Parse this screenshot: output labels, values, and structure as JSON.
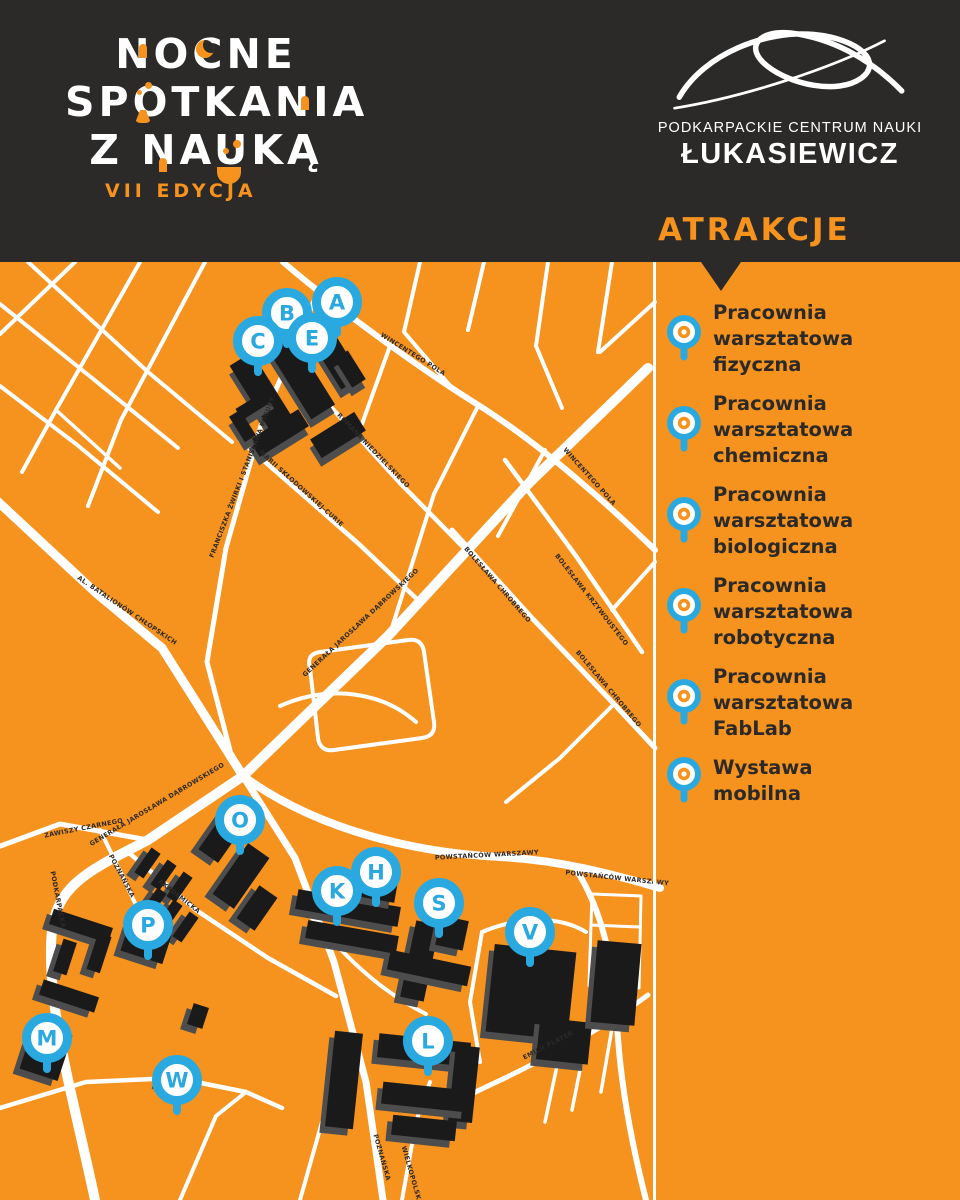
{
  "header": {
    "logo": {
      "line1": "NOCNE",
      "line2": "SPOTKANIA",
      "line3": "Z NAUKĄ",
      "edition": "VII EDYCJA"
    },
    "brand": {
      "line1": "PODKARPACKIE CENTRUM NAUKI",
      "line2": "ŁUKASIEWICZ"
    },
    "sidebar_title": "ATRAKCJE"
  },
  "sidebar": {
    "items": [
      {
        "lines": [
          "Pracownia",
          "warsztatowa",
          "fizyczna"
        ]
      },
      {
        "lines": [
          "Pracownia",
          "warsztatowa",
          "chemiczna"
        ]
      },
      {
        "lines": [
          "Pracownia",
          "warsztatowa",
          "biologiczna"
        ]
      },
      {
        "lines": [
          "Pracownia",
          "warsztatowa",
          "robotyczna"
        ]
      },
      {
        "lines": [
          "Pracownia",
          "warsztatowa",
          "FabLab"
        ]
      },
      {
        "lines": [
          "Wystawa",
          "mobilna"
        ]
      }
    ]
  },
  "map": {
    "colors": {
      "background": "#F6921E",
      "road": "#FFFFFF",
      "building": "#1A1A1A",
      "building_shadow": "#4D4D4D",
      "pin_blue": "#2AA9E0",
      "label": "#2B2A29",
      "header_black": "#2B2A29"
    },
    "pins": [
      {
        "label": "A",
        "x": 337,
        "y": 302
      },
      {
        "label": "B",
        "x": 287,
        "y": 313
      },
      {
        "label": "C",
        "x": 258,
        "y": 341
      },
      {
        "label": "E",
        "x": 312,
        "y": 338
      },
      {
        "label": "O",
        "x": 240,
        "y": 820
      },
      {
        "label": "P",
        "x": 148,
        "y": 925
      },
      {
        "label": "M",
        "x": 47,
        "y": 1038
      },
      {
        "label": "W",
        "x": 177,
        "y": 1080
      },
      {
        "label": "K",
        "x": 337,
        "y": 891
      },
      {
        "label": "H",
        "x": 376,
        "y": 872
      },
      {
        "label": "S",
        "x": 439,
        "y": 903
      },
      {
        "label": "V",
        "x": 530,
        "y": 932
      },
      {
        "label": "L",
        "x": 428,
        "y": 1041
      }
    ],
    "streets": [
      {
        "name": "WINCENTEGO POLA",
        "x": 412,
        "y": 356,
        "a": 32
      },
      {
        "name": "WINCENTEGO POLA",
        "x": 588,
        "y": 478,
        "a": 48
      },
      {
        "name": "ROMANA NIEDZIELSKIEGO",
        "x": 372,
        "y": 452,
        "a": 46
      },
      {
        "name": "FRANCISZKA ŻWIRKI I STANISŁAWA WIGURY",
        "x": 244,
        "y": 478,
        "a": -69
      },
      {
        "name": "MARII SKŁODOWSKIEJ-CURIE",
        "x": 300,
        "y": 490,
        "a": 42
      },
      {
        "name": "GENERAŁA JAROSŁAWA DĄBROWSKIEGO",
        "x": 362,
        "y": 624,
        "a": -43
      },
      {
        "name": "GENERAŁA JAROSŁAWA DĄBROWSKIEGO",
        "x": 158,
        "y": 806,
        "a": -31
      },
      {
        "name": "AL. BATALIONÓW CHŁOPSKICH",
        "x": 126,
        "y": 612,
        "a": 34
      },
      {
        "name": "ZAWISZY CZARNEGO",
        "x": 84,
        "y": 830,
        "a": -11
      },
      {
        "name": "PODKARPACKA",
        "x": 56,
        "y": 900,
        "a": 79
      },
      {
        "name": "POZNAŃSKA",
        "x": 120,
        "y": 877,
        "a": 62
      },
      {
        "name": "AKADEMICKA",
        "x": 178,
        "y": 898,
        "a": 38
      },
      {
        "name": "POWSTAŃCÓW WARSZAWY",
        "x": 487,
        "y": 857,
        "a": -3
      },
      {
        "name": "POWSTAŃCÓW WARSZAWY",
        "x": 617,
        "y": 880,
        "a": 6
      },
      {
        "name": "BOLESŁAWA CHROBREGO",
        "x": 496,
        "y": 586,
        "a": 49
      },
      {
        "name": "BOLESŁAWA KRZYWOUSTEGO",
        "x": 590,
        "y": 601,
        "a": 52
      },
      {
        "name": "BOLESŁAWA CHROBREGO",
        "x": 607,
        "y": 690,
        "a": 50
      },
      {
        "name": "EMILII PLATER",
        "x": 549,
        "y": 1047,
        "a": -27
      },
      {
        "name": "POZNAŃSKA",
        "x": 380,
        "y": 1158,
        "a": 74
      },
      {
        "name": "WIELKOPOLSKA",
        "x": 410,
        "y": 1176,
        "a": 74
      }
    ],
    "roads": [
      {
        "d": "M 648 368 L 530 482 L 388 636 L 243 776 L 148 840 C 95 868 58 882 52 930 C 45 1002 72 1092 95 1200",
        "w": 10
      },
      {
        "d": "M -6 498 L 95 592 L 162 648 L 243 776",
        "w": 9
      },
      {
        "d": "M 243 776 L 295 858 L 334 962 L 366 1082 L 383 1200",
        "w": 7
      },
      {
        "d": "M 243 776 C 320 832 420 853 500 857 C 560 860 612 874 660 888",
        "w": 8
      },
      {
        "d": "M 575 868 C 600 905 614 960 617 1022 C 620 1085 632 1145 646 1200",
        "w": 6
      },
      {
        "d": "M 283 262 C 345 315 425 372 483 408 C 548 450 614 510 655 550",
        "w": 6
      },
      {
        "d": "M 318 292 L 262 422 L 226 548 L 207 662 L 232 758",
        "w": 5
      },
      {
        "d": "M 240 440 L 303 495 L 360 545 L 420 602",
        "w": 4.5
      },
      {
        "d": "M 330 406 L 400 483 L 466 550",
        "w": 4.5
      },
      {
        "d": "M 452 530 L 532 618 L 614 704 L 655 748",
        "w": 5
      },
      {
        "d": "M 505 460 L 576 556 L 642 652",
        "w": 4.5
      },
      {
        "d": "M 648 995 C 600 1030 562 1050 505 1078 L 450 1104",
        "w": 5
      },
      {
        "d": "M -5 848 L 60 824 L 148 840",
        "w": 5
      },
      {
        "d": "M 128 852 L 196 910 L 268 958 L 336 996",
        "w": 4.5
      },
      {
        "d": "M 100 830 L 121 873 L 142 918",
        "w": 4
      },
      {
        "d": "M 75 262 L 0 334",
        "w": 4
      },
      {
        "d": "M 140 262 L 56 410 L 22 472",
        "w": 4
      },
      {
        "d": "M 205 262 L 121 420 L 88 506",
        "w": 4
      },
      {
        "d": "M 0 304 L 92 378 L 178 448",
        "w": 4
      },
      {
        "d": "M 0 386 L 76 444 L 158 512",
        "w": 4
      },
      {
        "d": "M 28 262 L 148 372 L 232 442",
        "w": 4
      },
      {
        "d": "M 56 410 L 120 468",
        "w": 3.5
      },
      {
        "d": "M 420 262 L 404 332 L 452 388",
        "w": 4
      },
      {
        "d": "M 484 262 L 468 330",
        "w": 4
      },
      {
        "d": "M 548 262 L 536 346 L 562 408",
        "w": 4
      },
      {
        "d": "M 612 262 L 598 352",
        "w": 4
      },
      {
        "d": "M 655 302 L 600 352",
        "w": 4
      },
      {
        "d": "M 390 346 L 362 424",
        "w": 4
      },
      {
        "d": "M 478 406 L 434 494 L 390 634",
        "w": 4
      },
      {
        "d": "M 545 450 L 498 536",
        "w": 4
      },
      {
        "d": "M 614 704 L 560 758 L 506 802",
        "w": 4
      },
      {
        "d": "M 655 562 L 612 610",
        "w": 4
      },
      {
        "d": "M 310 668 Q 306 654 320 652 L 408 640 Q 422 638 424 652 L 434 722 Q 436 736 422 738 L 334 750 Q 320 752 318 738 Z",
        "w": 4
      },
      {
        "d": "M 280 706 C 330 684 382 692 416 722",
        "w": 4
      },
      {
        "d": "M 0 1108 L 86 1082 L 176 1078 L 246 1092 L 282 1108",
        "w": 4.5
      },
      {
        "d": "M 180 1200 L 216 1116 L 246 1092",
        "w": 4
      },
      {
        "d": "M 300 1200 L 322 1122",
        "w": 4
      },
      {
        "d": "M 402 1200 L 416 1122 L 430 1082",
        "w": 4
      },
      {
        "d": "M 310 916 C 350 962 382 992 426 1014",
        "w": 4
      },
      {
        "d": "M 482 932 L 470 1002 L 480 1062",
        "w": 4
      },
      {
        "d": "M 482 932 C 520 916 560 916 586 932",
        "w": 4
      },
      {
        "d": "M 560 1052 L 545 1122",
        "w": 3.5
      },
      {
        "d": "M 586 1040 L 572 1110",
        "w": 3.5
      },
      {
        "d": "M 612 1028 L 601 1092",
        "w": 3.5
      },
      {
        "d": "M 592 894 L 641 896 L 639 988 L 589 986 Z",
        "w": 3
      },
      {
        "d": "M 591 925 L 640 927",
        "w": 3
      },
      {
        "d": "M 590 956 L 639 958",
        "w": 3
      }
    ],
    "buildings": [
      {
        "x": 252,
        "y": 352,
        "w": 26,
        "h": 92,
        "r": -32
      },
      {
        "x": 288,
        "y": 338,
        "w": 28,
        "h": 80,
        "r": -32
      },
      {
        "x": 323,
        "y": 326,
        "w": 24,
        "h": 62,
        "r": -32
      },
      {
        "x": 250,
        "y": 423,
        "w": 58,
        "h": 20,
        "r": -32
      },
      {
        "x": 312,
        "y": 424,
        "w": 52,
        "h": 22,
        "r": -32
      },
      {
        "x": 236,
        "y": 398,
        "w": 38,
        "h": 13,
        "r": -32
      },
      {
        "x": 236,
        "y": 411,
        "w": 13,
        "h": 30,
        "r": -32
      },
      {
        "x": 342,
        "y": 352,
        "w": 16,
        "h": 34,
        "r": -32
      },
      {
        "x": 212,
        "y": 806,
        "w": 24,
        "h": 55,
        "r": 35
      },
      {
        "x": 228,
        "y": 845,
        "w": 26,
        "h": 62,
        "r": 35
      },
      {
        "x": 246,
        "y": 888,
        "w": 22,
        "h": 40,
        "r": 35
      },
      {
        "x": 142,
        "y": 848,
        "w": 11,
        "h": 30,
        "r": 35
      },
      {
        "x": 158,
        "y": 860,
        "w": 11,
        "h": 30,
        "r": 35
      },
      {
        "x": 174,
        "y": 872,
        "w": 11,
        "h": 30,
        "r": 35
      },
      {
        "x": 148,
        "y": 888,
        "w": 11,
        "h": 30,
        "r": 35
      },
      {
        "x": 164,
        "y": 900,
        "w": 11,
        "h": 30,
        "r": 35
      },
      {
        "x": 180,
        "y": 912,
        "w": 11,
        "h": 30,
        "r": 35
      },
      {
        "x": 50,
        "y": 918,
        "w": 62,
        "h": 16,
        "r": 18
      },
      {
        "x": 58,
        "y": 940,
        "w": 14,
        "h": 34,
        "r": 18
      },
      {
        "x": 92,
        "y": 934,
        "w": 14,
        "h": 38,
        "r": 18
      },
      {
        "x": 124,
        "y": 928,
        "w": 44,
        "h": 30,
        "r": 18
      },
      {
        "x": 40,
        "y": 988,
        "w": 58,
        "h": 16,
        "r": 18
      },
      {
        "x": 26,
        "y": 1028,
        "w": 40,
        "h": 48,
        "r": 18
      },
      {
        "x": 162,
        "y": 1062,
        "w": 24,
        "h": 26,
        "r": 18
      },
      {
        "x": 190,
        "y": 1005,
        "w": 16,
        "h": 22,
        "r": 18
      },
      {
        "x": 296,
        "y": 898,
        "w": 104,
        "h": 20,
        "r": 10
      },
      {
        "x": 306,
        "y": 928,
        "w": 92,
        "h": 18,
        "r": 10
      },
      {
        "x": 362,
        "y": 882,
        "w": 34,
        "h": 18,
        "r": 10
      },
      {
        "x": 408,
        "y": 922,
        "w": 24,
        "h": 78,
        "r": 12
      },
      {
        "x": 388,
        "y": 958,
        "w": 82,
        "h": 20,
        "r": 12
      },
      {
        "x": 438,
        "y": 918,
        "w": 28,
        "h": 30,
        "r": 12
      },
      {
        "x": 490,
        "y": 948,
        "w": 82,
        "h": 88,
        "r": 6
      },
      {
        "x": 538,
        "y": 1020,
        "w": 52,
        "h": 42,
        "r": 6
      },
      {
        "x": 594,
        "y": 942,
        "w": 44,
        "h": 82,
        "r": 5
      },
      {
        "x": 330,
        "y": 1032,
        "w": 28,
        "h": 96,
        "r": 6
      },
      {
        "x": 378,
        "y": 1038,
        "w": 92,
        "h": 24,
        "r": 6
      },
      {
        "x": 452,
        "y": 1046,
        "w": 24,
        "h": 76,
        "r": 6
      },
      {
        "x": 382,
        "y": 1086,
        "w": 86,
        "h": 22,
        "r": 6
      },
      {
        "x": 392,
        "y": 1118,
        "w": 64,
        "h": 20,
        "r": 6
      }
    ]
  }
}
